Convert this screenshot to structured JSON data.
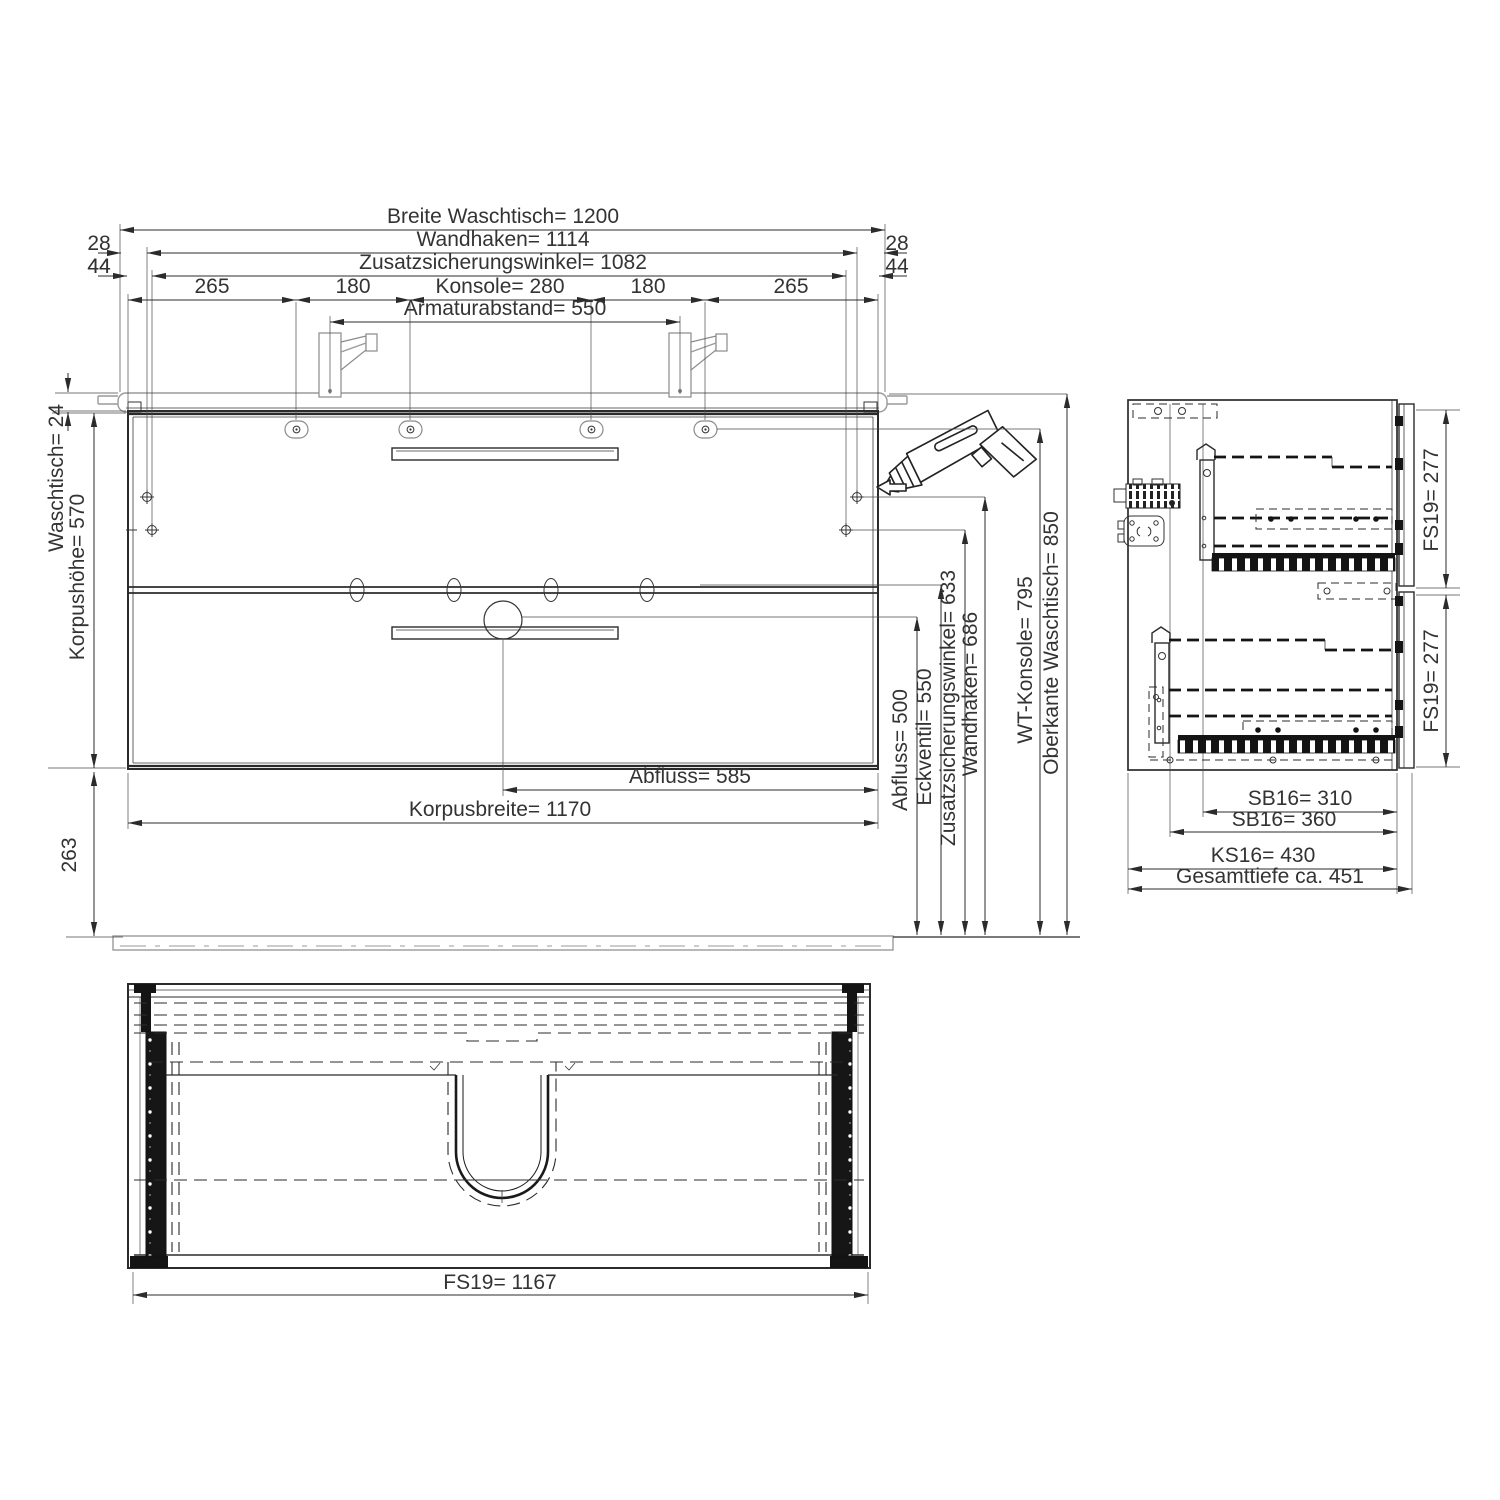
{
  "front_view": {
    "dims_top": {
      "breite_waschtisch": "Breite Waschtisch= 1200",
      "offset_left_28": "28",
      "offset_right_28": "28",
      "wandhaken": "Wandhaken=  1114",
      "offset_left_44": "44",
      "offset_right_44": "44",
      "zusatzsicherungswinkel": "Zusatzsicherungswinkel=  1082",
      "seg_265_left": "265",
      "seg_180_left": "180",
      "konsole": "Konsole= 280",
      "seg_180_right": "180",
      "seg_265_right": "265",
      "armaturabstand": "Armaturabstand= 550"
    },
    "dims_left": {
      "waschtisch": "Waschtisch= 24",
      "korpushoehe": "Korpushöhe= 570",
      "sockel": "263"
    },
    "dims_bottom": {
      "abfluss": "Abfluss= 585",
      "korpusbreite": "Korpusbreite=  1170"
    },
    "dims_right": {
      "abfluss": "Abfluss= 500",
      "eckventil": "Eckventil= 550",
      "zusatzsicherungswinkel": "Zusatzsicherungswinkel= 633",
      "wandhaken": "Wandhaken= 686",
      "wt_konsole": "WT-Konsole= 795",
      "oberkante_waschtisch": "Oberkante Waschtisch= 850"
    }
  },
  "side_view": {
    "dims_right": {
      "fs19_top": "FS19=  277",
      "fs19_bottom": "FS19=  277"
    },
    "dims_bottom": {
      "sb16_inner": "SB16= 310",
      "sb16_outer": "SB16=  360",
      "ks16": "KS16=  430",
      "gesamttiefe": "Gesamttiefe ca. 451"
    }
  },
  "plan_view": {
    "dims_bottom": {
      "fs19": "FS19= 1167"
    }
  },
  "colors": {
    "line": "#2b2b2b",
    "light_gray": "#9a9a9a",
    "text": "#333333",
    "background": "#ffffff"
  }
}
